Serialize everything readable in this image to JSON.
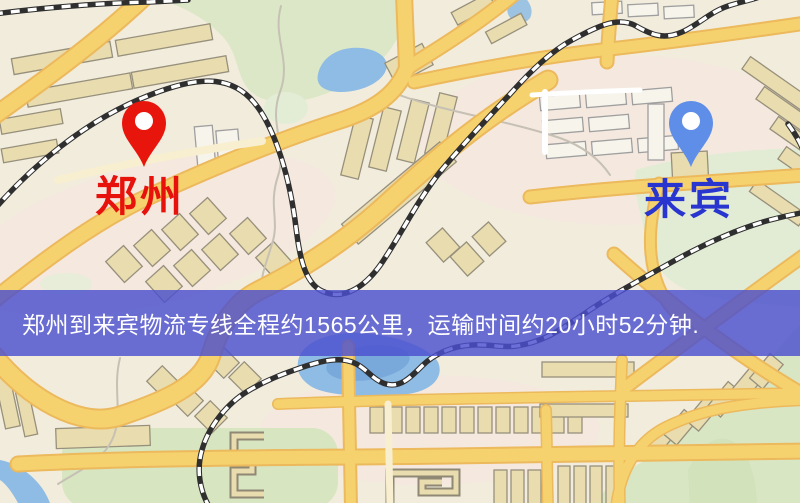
{
  "banner": {
    "text": "郑州到来宾物流专线全程约1565公里，运输时间约20小时52分钟.",
    "background": "#4a4fce",
    "text_color": "#ffffff"
  },
  "map": {
    "origin": {
      "label": "郑州",
      "label_color": "#e8120c",
      "pin_color": "#e8150d"
    },
    "destination": {
      "label": "来宾",
      "label_color": "#2835cf",
      "pin_color": "#5f8ee8"
    },
    "colors": {
      "land": "#f2ecdd",
      "park": "#dbe7c6",
      "water": "#8fbce4",
      "road_fill": "#f6d26e",
      "road_casing": "#ecb95c",
      "building": "#e9dcae",
      "building_light": "#f7f4ec",
      "railway": "#333333"
    }
  }
}
